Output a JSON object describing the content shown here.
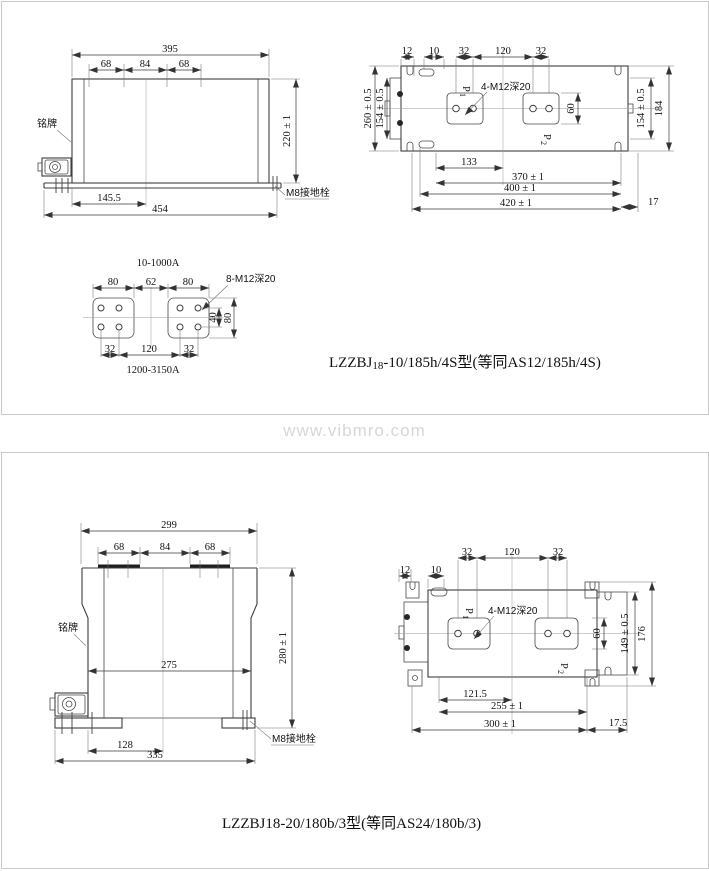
{
  "watermark": "www.vibmro.com",
  "panel1": {
    "caption": {
      "prefix": "LZZBJ",
      "sub": "18",
      "rest": "-10/185h/4S型(等同AS12/185h/4S)"
    },
    "front": {
      "d395": "395",
      "d68a": "68",
      "d84": "84",
      "d68b": "68",
      "d220": "220 ± 1",
      "d145": "145.5",
      "d454": "454",
      "nameplate": "铭牌",
      "ground": "M8接地栓"
    },
    "top": {
      "d12": "12",
      "d10": "10",
      "d32a": "32",
      "d120": "120",
      "d32b": "32",
      "d260": "260 ± 0.5",
      "d154l": "154 ± 0.5",
      "d154r": "154 ± 0.5",
      "d184": "184",
      "d60": "60",
      "d133": "133",
      "d370": "370 ± 1",
      "d400": "400 ± 1",
      "d420": "420 ± 1",
      "d17": "17",
      "holes": "4-M12深20",
      "p1": {
        "base": "P",
        "sub": "1"
      },
      "p2": {
        "base": "P",
        "sub": "2"
      }
    },
    "terminal": {
      "range_top": "10-1000A",
      "range_bottom": "1200-3150A",
      "holes": "8-M12深20",
      "d80a": "80",
      "d62": "62",
      "d80b": "80",
      "d32a": "32",
      "d120": "120",
      "d32b": "32",
      "d40": "40",
      "d80r": "80"
    }
  },
  "panel2": {
    "caption": {
      "prefix": "LZZBJ18",
      "sub": "",
      "rest": "-20/180b/3型(等同AS24/180b/3)"
    },
    "front": {
      "d299": "299",
      "d68a": "68",
      "d84": "84",
      "d68b": "68",
      "d280": "280 ± 1",
      "d275": "275",
      "d128": "128",
      "d335": "335",
      "nameplate": "铭牌",
      "ground": "M8接地栓"
    },
    "top": {
      "d12": "12",
      "d10": "10",
      "d32a": "32",
      "d120": "120",
      "d32b": "32",
      "d149": "149 ± 0.5",
      "d176": "176",
      "d60": "60",
      "d121": "121.5",
      "d255": "255 ± 1",
      "d300": "300 ± 1",
      "d175": "17.5",
      "holes": "4-M12深20",
      "p1": {
        "base": "P",
        "sub": "1"
      },
      "p2": {
        "base": "P",
        "sub": "2"
      }
    }
  }
}
